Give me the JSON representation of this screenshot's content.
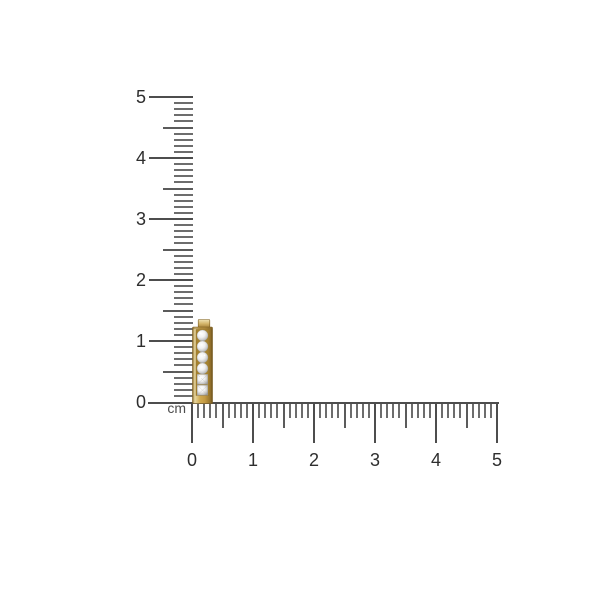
{
  "canvas": {
    "background": "#ffffff"
  },
  "ruler": {
    "unit_label": "cm",
    "vertical_labels": [
      "5",
      "4",
      "3",
      "2",
      "1",
      "0"
    ],
    "horizontal_labels": [
      "0",
      "1",
      "2",
      "3",
      "4",
      "5"
    ],
    "cm_min": 0,
    "cm_max": 5,
    "minor_ticks_per_cm": 10,
    "tick_color": "#4d4d4d",
    "number_color": "#2e2e2e"
  },
  "item": {
    "name": "yellow-gold-channel-set-diamond-earring",
    "gold_color": "#c49a43",
    "stone_color": "#ededed",
    "stone_count_visible": 6,
    "approx_length_cm": 1.4,
    "approx_width_cm": 0.35
  }
}
